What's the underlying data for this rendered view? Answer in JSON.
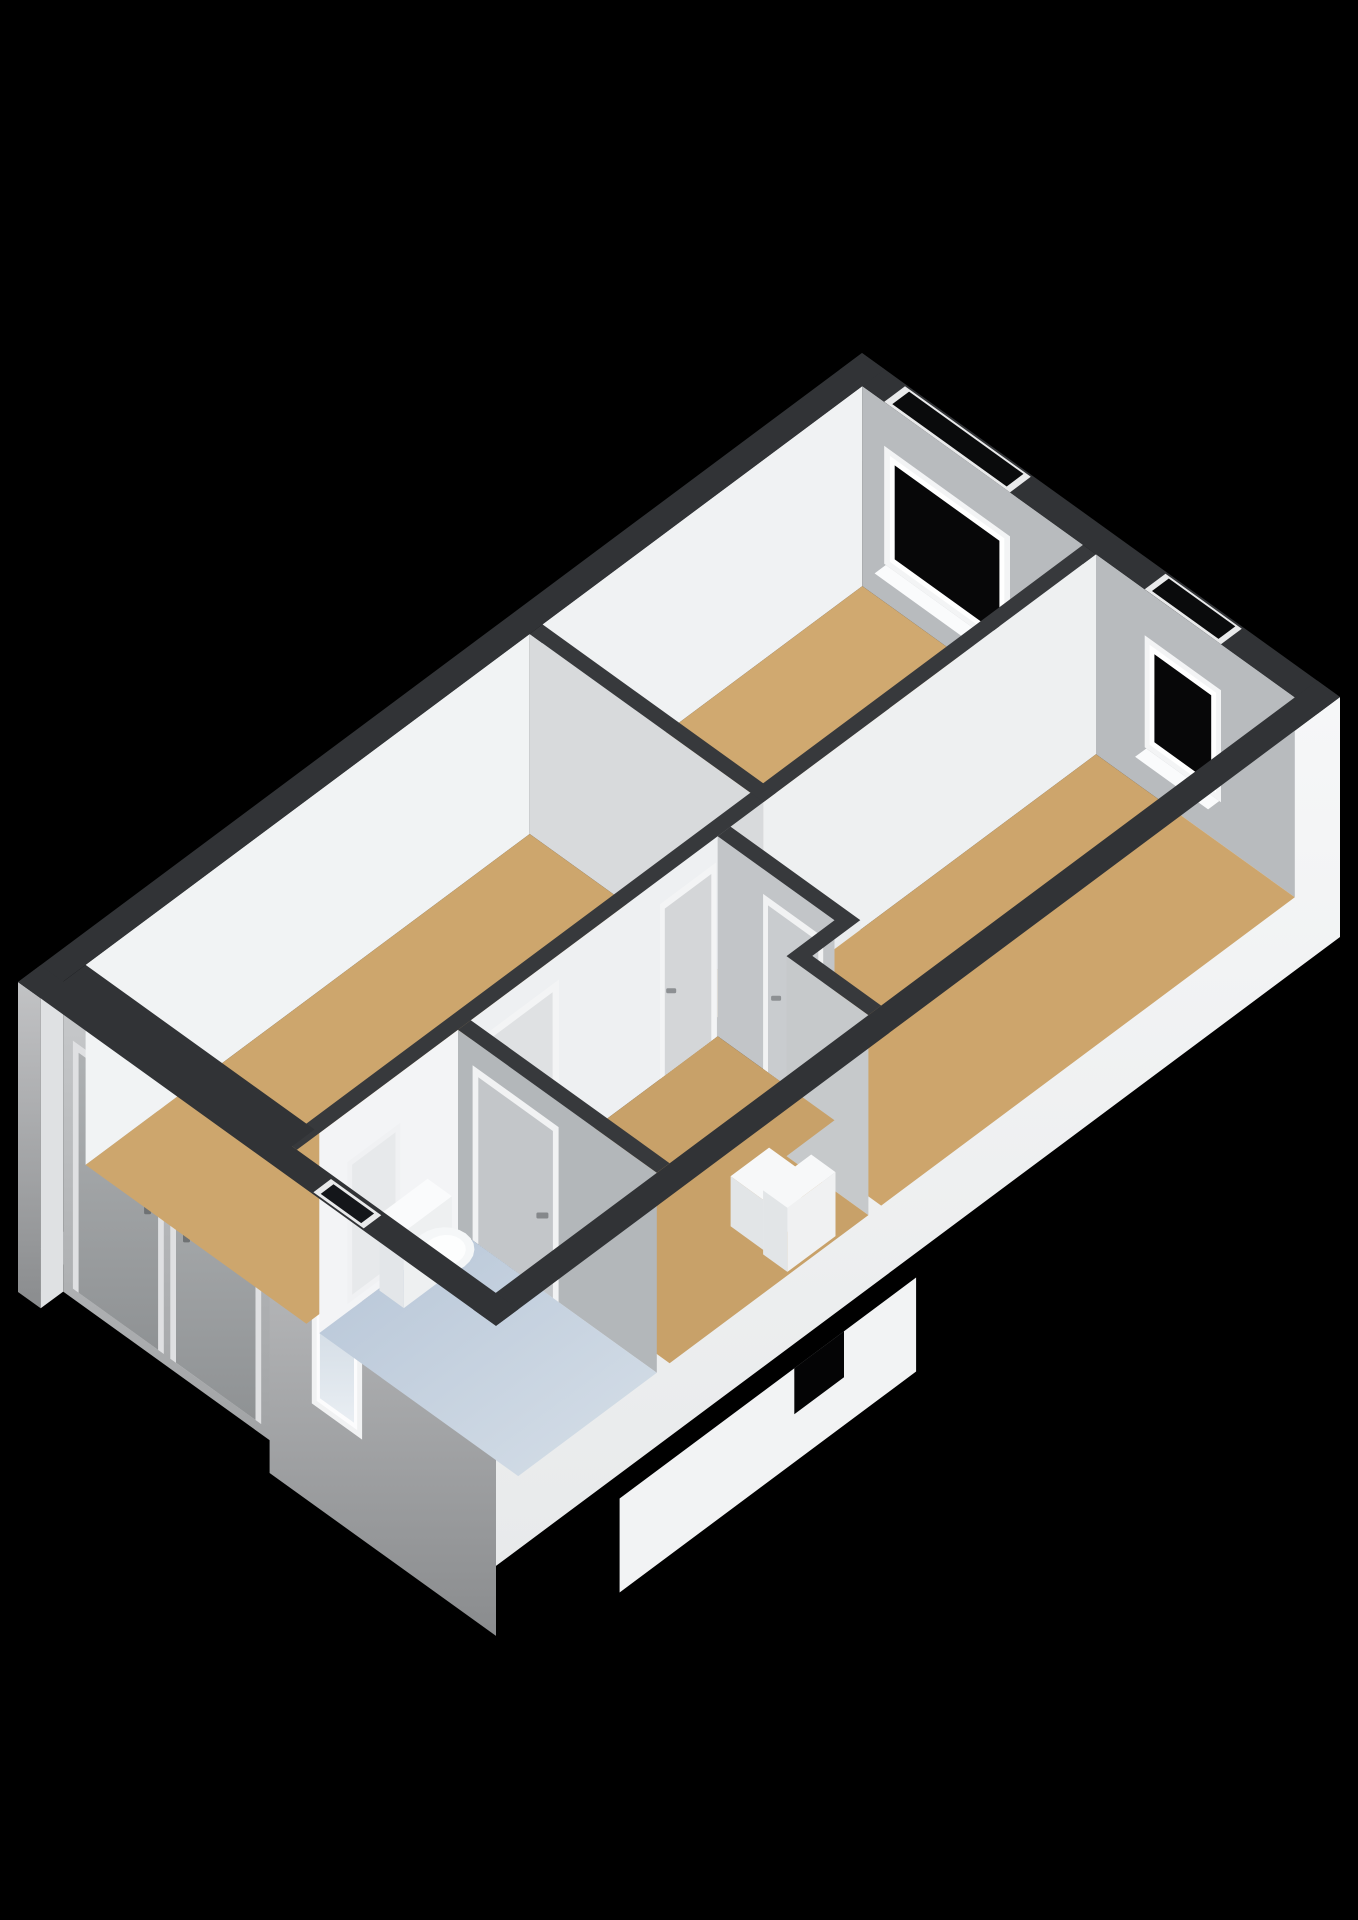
{
  "page": {
    "background": "#000000",
    "width": 1358,
    "height": 1920,
    "title": "3d-floorplan-render"
  },
  "projection": {
    "origin": [
      862,
      353
    ],
    "u": [
      0.8115,
      0.584
    ],
    "v": [
      -0.8015,
      0.5973
    ]
  },
  "palette": {
    "background": "#000000",
    "wall_top_exterior": "#313336",
    "wall_top_interior": "#37393c",
    "interior_face_bright": "#f0f2f3",
    "interior_face_gray": "#b8bbbe",
    "floor_wood": "#cda66d",
    "floor_bathroom_blue": "#c2d0df",
    "window_glass": "#070708",
    "window_frame": "#f3f4f5",
    "door_gray": "#a6a9ab",
    "fixture_white": "#fafbfc"
  },
  "scene": [
    {
      "name": "porch-floor",
      "kind": "floor",
      "rect": [
        28,
        1025,
        310,
        1053
      ],
      "drop": 250,
      "fill": "#94989c"
    },
    {
      "name": "exterior-wall-sw-west-sliver",
      "kind": "faceV",
      "t": 1053,
      "s1": 0,
      "s2": 28,
      "d1": 0,
      "d2": 310,
      "fill": "url(#gExtSW)"
    },
    {
      "name": "porch-side-wall",
      "kind": "faceU",
      "s": 28,
      "t1": 1025,
      "t2": 1053,
      "d1": 0,
      "d2": 310,
      "fill": "#dfe1e3"
    },
    {
      "name": "porch-back-wall",
      "kind": "faceV",
      "t": 1025,
      "s1": 28,
      "s2": 310,
      "d1": 0,
      "d2": 310,
      "fill": "url(#gRecess)"
    },
    {
      "name": "front-door-1-frame",
      "kind": "faceV",
      "t": 1025,
      "s1": 40,
      "s2": 152,
      "d1": 52,
      "d2": 300,
      "fill": "#dfe0e2"
    },
    {
      "name": "front-door-1-panel",
      "kind": "faceV",
      "t": 1025,
      "s1": 47,
      "s2": 145,
      "d1": 60,
      "d2": 300,
      "fill": "url(#gDoorExt)"
    },
    {
      "name": "front-door-1-handle",
      "kind": "mark",
      "at": [
        132,
        1025,
        165
      ],
      "w": 7,
      "h": 14,
      "fill": "#6f7274"
    },
    {
      "name": "front-door-2-frame",
      "kind": "faceV",
      "t": 1025,
      "s1": 160,
      "s2": 272,
      "d1": 52,
      "d2": 300,
      "fill": "#dfe0e2"
    },
    {
      "name": "front-door-2-panel",
      "kind": "faceV",
      "t": 1025,
      "s1": 167,
      "s2": 265,
      "d1": 60,
      "d2": 300,
      "fill": "url(#gDoorExt)"
    },
    {
      "name": "front-door-2-handle",
      "kind": "mark",
      "at": [
        180,
        1025,
        165
      ],
      "w": 7,
      "h": 14,
      "fill": "#6f7274"
    },
    {
      "name": "exterior-wall-sw",
      "kind": "faceV",
      "t": 1053,
      "s1": 310,
      "s2": 589,
      "d1": 0,
      "d2": 310,
      "fill": "url(#gExtSW)"
    },
    {
      "name": "bathroom-window-frame",
      "kind": "faceV",
      "t": 1053,
      "s1": 362,
      "s2": 424,
      "d1": 52,
      "d2": 210,
      "fill": "#f1f2f3"
    },
    {
      "name": "bathroom-window-frame-inner",
      "kind": "faceV",
      "t": 1053,
      "s1": 368,
      "s2": 418,
      "d1": 58,
      "d2": 204,
      "fill": "#fcfcfd"
    },
    {
      "name": "bathroom-window-glass",
      "kind": "faceV",
      "t": 1053,
      "s1": 372,
      "s2": 414,
      "d1": 63,
      "d2": 199,
      "fill": "url(#gGlassFrost)"
    },
    {
      "name": "exterior-wall-se",
      "kind": "faceU",
      "s": 589,
      "t1": 0,
      "t2": 1053,
      "d1": 0,
      "d2": 240,
      "fill": "url(#gExtSE)"
    },
    {
      "name": "entrance-landing",
      "kind": "faceU",
      "s": 589,
      "t1": 560,
      "t2": 930,
      "d1": 228,
      "d2": 322,
      "fill": "#f2f3f4",
      "offset": [
        25,
        18
      ]
    },
    {
      "name": "entrance-landing-notch",
      "kind": "faceU",
      "s": 589,
      "t1": 650,
      "t2": 712,
      "d1": 228,
      "d2": 274,
      "fill": "#040405",
      "offset": [
        25,
        18
      ]
    },
    {
      "name": "bedroom1-wall-nw",
      "kind": "faceU",
      "s": 28,
      "t1": 28,
      "t2": 427,
      "d1": 0,
      "d2": 200,
      "fill": "#f0f2f3"
    },
    {
      "name": "bedroom1-wall-ne",
      "kind": "faceV",
      "t": 28,
      "s1": 28,
      "s2": 300,
      "d1": 0,
      "d2": 200,
      "fill": "#b8bbbe"
    },
    {
      "name": "bedroom1-window-frame",
      "kind": "faceV",
      "t": 28,
      "s1": 55,
      "s2": 210,
      "d1": 44,
      "d2": 162,
      "fill": "#f3f4f5"
    },
    {
      "name": "bedroom1-window-frame-inner",
      "kind": "faceV",
      "t": 28,
      "s1": 62,
      "s2": 203,
      "d1": 50,
      "d2": 156,
      "fill": "#ffffff"
    },
    {
      "name": "bedroom1-window-glass",
      "kind": "faceV",
      "t": 28,
      "s1": 68,
      "s2": 197,
      "d1": 56,
      "d2": 150,
      "fill": "#070708"
    },
    {
      "name": "bedroom1-window-sill",
      "kind": "floor",
      "rect": [
        57,
        28,
        208,
        42
      ],
      "drop": 162,
      "fill": "#fafbfc"
    },
    {
      "name": "bedroom1-floor",
      "kind": "floor",
      "rect": [
        28,
        28,
        300,
        427
      ],
      "drop": 200,
      "fill": "#d0a970"
    },
    {
      "name": "bedroom2-wall-nw",
      "kind": "faceU",
      "s": 316,
      "t1": 28,
      "t2": 484,
      "d1": 0,
      "d2": 200,
      "fill": "#eef0f1"
    },
    {
      "name": "bedroom2-wall-ne",
      "kind": "faceV",
      "t": 28,
      "s1": 316,
      "s2": 561,
      "d1": 0,
      "d2": 200,
      "fill": "#b8bbbe"
    },
    {
      "name": "bedroom2-window-frame",
      "kind": "faceV",
      "t": 28,
      "s1": 376,
      "s2": 470,
      "d1": 46,
      "d2": 158,
      "fill": "#f3f4f5"
    },
    {
      "name": "bedroom2-window-frame-inner",
      "kind": "faceV",
      "t": 28,
      "s1": 382,
      "s2": 464,
      "d1": 52,
      "d2": 152,
      "fill": "#ffffff"
    },
    {
      "name": "bedroom2-window-glass",
      "kind": "faceV",
      "t": 28,
      "s1": 388,
      "s2": 458,
      "d1": 58,
      "d2": 146,
      "fill": "#070708"
    },
    {
      "name": "bedroom2-window-sill",
      "kind": "floor",
      "rect": [
        378,
        28,
        468,
        42
      ],
      "drop": 158,
      "fill": "#fafbfc"
    },
    {
      "name": "bedroom2-jog-wall-face",
      "kind": "faceU",
      "s": 476,
      "t1": 484,
      "t2": 544,
      "d1": 0,
      "d2": 200,
      "fill": "#e9ebed"
    },
    {
      "name": "bedroom2-floor",
      "kind": "floor",
      "poly": [
        [
          316,
          28
        ],
        [
          561,
          28
        ],
        [
          561,
          544
        ],
        [
          476,
          544
        ],
        [
          476,
          484
        ],
        [
          316,
          484
        ]
      ],
      "drop": 200,
      "fill": "#cda56c"
    },
    {
      "name": "livingroom-wall-nw",
      "kind": "faceU",
      "s": 28,
      "t1": 443,
      "t2": 997,
      "d1": 0,
      "d2": 200,
      "fill": "#f1f3f4"
    },
    {
      "name": "livingroom-wall-ne",
      "kind": "faceV",
      "t": 443,
      "s1": 28,
      "s2": 316,
      "d1": 0,
      "d2": 200,
      "fill": "#d8dadc"
    },
    {
      "name": "livingroom-floor",
      "kind": "floor",
      "rect": [
        28,
        443,
        300,
        997
      ],
      "drop": 200,
      "fill": "#cda66d"
    },
    {
      "name": "hallway-wall-nw",
      "kind": "faceU",
      "s": 316,
      "t1": 500,
      "t2": 808,
      "d1": 0,
      "d2": 200,
      "fill": "#eef0f2"
    },
    {
      "name": "hallway-door-living-1-frame",
      "kind": "faceU",
      "s": 316,
      "t1": 502,
      "t2": 572,
      "d1": 25,
      "d2": 200,
      "fill": "#f3f4f5"
    },
    {
      "name": "hallway-door-living-1-panel",
      "kind": "faceU",
      "s": 316,
      "t1": 508,
      "t2": 566,
      "d1": 33,
      "d2": 200,
      "fill": "#d4d6d8"
    },
    {
      "name": "hallway-door-living-1-handle",
      "kind": "mark",
      "at": [
        316,
        558,
        120
      ],
      "w": 10,
      "h": 5,
      "fill": "#8d9093"
    },
    {
      "name": "hallway-door-living-2-frame",
      "kind": "faceU",
      "s": 316,
      "t1": 698,
      "t2": 792,
      "d1": 25,
      "d2": 200,
      "fill": "#f3f4f5"
    },
    {
      "name": "hallway-door-living-2-panel",
      "kind": "faceU",
      "s": 316,
      "t1": 706,
      "t2": 784,
      "d1": 33,
      "d2": 200,
      "fill": "#dfe1e3"
    },
    {
      "name": "hallway-door-living-2-handle",
      "kind": "mark",
      "at": [
        316,
        714,
        120
      ],
      "w": 10,
      "h": 5,
      "fill": "#8d9093"
    },
    {
      "name": "hallway-wall-ne",
      "kind": "faceV",
      "t": 500,
      "s1": 316,
      "s2": 460,
      "d1": 0,
      "d2": 200,
      "fill": "#c2c5c8"
    },
    {
      "name": "bedroom2-door-frame",
      "kind": "faceV",
      "t": 500,
      "s1": 372,
      "s2": 446,
      "d1": 25,
      "d2": 200,
      "fill": "#f1f2f3"
    },
    {
      "name": "bedroom2-door-panel",
      "kind": "faceV",
      "t": 500,
      "s1": 378,
      "s2": 440,
      "d1": 33,
      "d2": 200,
      "fill": "#c9cccf"
    },
    {
      "name": "bedroom2-door-handle",
      "kind": "mark",
      "at": [
        388,
        500,
        120
      ],
      "w": 10,
      "h": 5,
      "fill": "#8d9093"
    },
    {
      "name": "hallway-wall-ne-east",
      "kind": "faceV",
      "t": 560,
      "s1": 460,
      "s2": 561,
      "d1": 0,
      "d2": 200,
      "fill": "#c6c9cb"
    },
    {
      "name": "hallway-floor",
      "kind": "floor",
      "poly": [
        [
          316,
          500
        ],
        [
          460,
          500
        ],
        [
          460,
          560
        ],
        [
          561,
          560
        ],
        [
          561,
          808
        ],
        [
          316,
          808
        ]
      ],
      "drop": 200,
      "fill": "#c8a169"
    },
    {
      "name": "hallway-cabinet-low",
      "kind": "box",
      "rect": [
        484,
        606,
        524,
        654
      ],
      "dTop": 150,
      "dBottom": 200,
      "fillTop": "#f7f8f9",
      "fillU": "#f0f1f2",
      "fillV": "#e2e5e7"
    },
    {
      "name": "hallway-cabinet-high",
      "kind": "box",
      "rect": [
        528,
        598,
        558,
        658
      ],
      "dTop": 136,
      "dBottom": 200,
      "fillTop": "#f7f8f9",
      "fillU": "#f0f1f2",
      "fillV": "#e2e5e7"
    },
    {
      "name": "wc-wall-nw",
      "kind": "faceU",
      "s": 316,
      "t1": 824,
      "t2": 997,
      "d1": 0,
      "d2": 200,
      "fill": "#f3f4f6"
    },
    {
      "name": "wc-shower-panel-frame",
      "kind": "faceU",
      "s": 316,
      "t1": 896,
      "t2": 962,
      "d1": 50,
      "d2": 192,
      "fill": "#f0f1f3"
    },
    {
      "name": "wc-shower-panel",
      "kind": "faceU",
      "s": 316,
      "t1": 902,
      "t2": 956,
      "d1": 56,
      "d2": 186,
      "fill": "#e7e9eb"
    },
    {
      "name": "wc-wall-ne",
      "kind": "faceV",
      "t": 824,
      "s1": 316,
      "s2": 561,
      "d1": 0,
      "d2": 200,
      "fill": "#b3b7ba"
    },
    {
      "name": "wc-door-frame",
      "kind": "faceV",
      "t": 824,
      "s1": 334,
      "s2": 440,
      "d1": 25,
      "d2": 200,
      "fill": "#f1f2f3"
    },
    {
      "name": "wc-door-panel",
      "kind": "faceV",
      "t": 824,
      "s1": 341,
      "s2": 433,
      "d1": 33,
      "d2": 200,
      "fill": "#c3c6c9"
    },
    {
      "name": "wc-door-handle",
      "kind": "mark",
      "at": [
        420,
        824,
        125
      ],
      "w": 12,
      "h": 6,
      "fill": "#85888b"
    },
    {
      "name": "wc-floor",
      "kind": "floor",
      "rect": [
        316,
        824,
        561,
        997
      ],
      "drop": 200,
      "fill": "url(#gFloorWC)"
    },
    {
      "name": "toilet-tank",
      "kind": "box",
      "rect": [
        318,
        864,
        348,
        924
      ],
      "dTop": 124,
      "dBottom": 200,
      "fillTop": "#fafbfc",
      "fillU": "#eef0f1",
      "fillV": "#e3e6e9"
    },
    {
      "name": "toilet-bowl",
      "kind": "disk",
      "c": [
        366,
        894
      ],
      "r": [
        27,
        29
      ],
      "drop": 150,
      "fill": "#f5f7f8"
    },
    {
      "name": "toilet-seat",
      "kind": "disk",
      "c": [
        368,
        894
      ],
      "r": [
        18,
        20
      ],
      "drop": 149,
      "fill": "#fdfefe"
    },
    {
      "name": "wall-top-partition-long",
      "kind": "top",
      "rect": [
        300,
        28,
        316,
        1025
      ],
      "fill": "#37393c"
    },
    {
      "name": "wall-top-bedroom1-sw",
      "kind": "top",
      "rect": [
        28,
        427,
        316,
        443
      ],
      "fill": "#37393c"
    },
    {
      "name": "wall-top-bedroom2-sw",
      "kind": "top",
      "poly": [
        [
          316,
          484
        ],
        [
          476,
          484
        ],
        [
          476,
          544
        ],
        [
          561,
          544
        ],
        [
          561,
          560
        ],
        [
          460,
          560
        ],
        [
          460,
          500
        ],
        [
          316,
          500
        ]
      ],
      "fill": "#37393c"
    },
    {
      "name": "wall-top-wc-ne",
      "kind": "top",
      "rect": [
        316,
        808,
        561,
        824
      ],
      "fill": "#37393c"
    },
    {
      "name": "wall-top-exterior-ne",
      "kind": "top",
      "rect": [
        0,
        0,
        589,
        28
      ],
      "fill": "#313336"
    },
    {
      "name": "bedroom1-window-head-frame",
      "kind": "top",
      "rect": [
        55,
        2,
        210,
        28
      ],
      "fill": "#e9eaeb"
    },
    {
      "name": "bedroom1-window-head-void",
      "kind": "top",
      "rect": [
        62,
        4,
        203,
        25
      ],
      "fill": "#0a0b0c"
    },
    {
      "name": "bedroom2-window-head-frame",
      "kind": "top",
      "rect": [
        376,
        2,
        470,
        28
      ],
      "fill": "#e9eaeb"
    },
    {
      "name": "bedroom2-window-head-void",
      "kind": "top",
      "rect": [
        382,
        4,
        464,
        25
      ],
      "fill": "#0a0b0c"
    },
    {
      "name": "wall-top-exterior-nw",
      "kind": "top",
      "rect": [
        0,
        0,
        28,
        1053
      ],
      "fill": "#313336"
    },
    {
      "name": "wall-top-exterior-se",
      "kind": "top",
      "rect": [
        561,
        0,
        589,
        1053
      ],
      "fill": "#313336"
    },
    {
      "name": "wall-top-exterior-sw",
      "kind": "top",
      "poly": [
        [
          0,
          1025
        ],
        [
          28,
          1025
        ],
        [
          28,
          997
        ],
        [
          310,
          997
        ],
        [
          310,
          1025
        ],
        [
          589,
          1025
        ],
        [
          589,
          1053
        ],
        [
          0,
          1053
        ]
      ],
      "fill": "#313336"
    },
    {
      "name": "bathroom-window-head-frame",
      "kind": "top",
      "rect": [
        362,
        1029,
        424,
        1051
      ],
      "fill": "#e9eaeb"
    },
    {
      "name": "bathroom-window-head-void",
      "kind": "top",
      "rect": [
        368,
        1032,
        418,
        1048
      ],
      "fill": "#14161a"
    }
  ]
}
